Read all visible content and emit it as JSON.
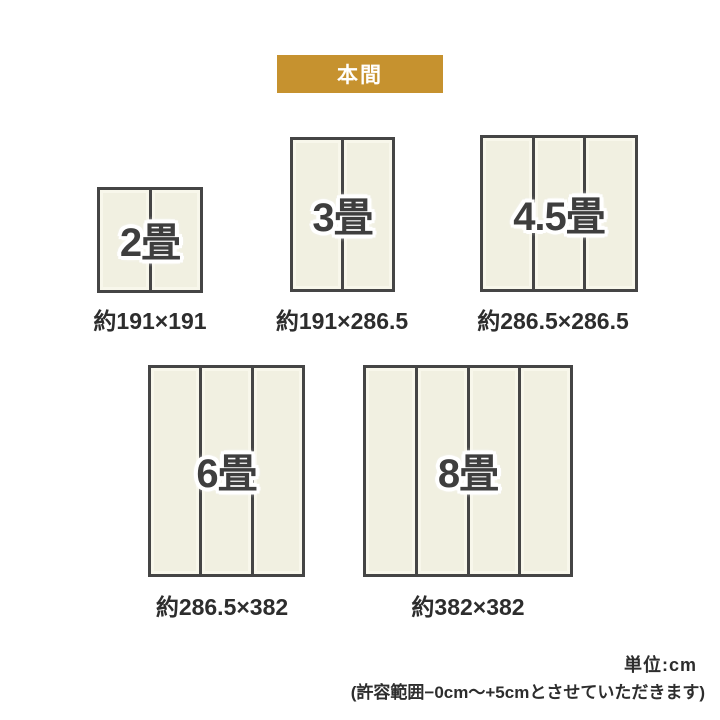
{
  "badge": {
    "label": "本間"
  },
  "sizes": [
    {
      "id": "2jo",
      "label": "2畳",
      "dimensions": "約191×191",
      "panels": 2
    },
    {
      "id": "3jo",
      "label": "3畳",
      "dimensions": "約191×286.5",
      "panels": 2
    },
    {
      "id": "4-5jo",
      "label": "4.5畳",
      "dimensions": "約286.5×286.5",
      "panels": 3
    },
    {
      "id": "6jo",
      "label": "6畳",
      "dimensions": "約286.5×382",
      "panels": 3
    },
    {
      "id": "8jo",
      "label": "8畳",
      "dimensions": "約382×382",
      "panels": 4
    }
  ],
  "footer": {
    "unit_label": "単位:cm",
    "tolerance_note": "(許容範囲−0cm〜+5cmとさせていただきます)"
  },
  "colors": {
    "page_background": "#ffffff",
    "badge_background": "#c6922f",
    "badge_text": "#ffffff",
    "tatami_fill": "#f1f0e1",
    "tatami_highlight": "#f8f7eb",
    "border": "#454545",
    "label_text": "#3e3e3e",
    "text": "#2d2d2d"
  }
}
